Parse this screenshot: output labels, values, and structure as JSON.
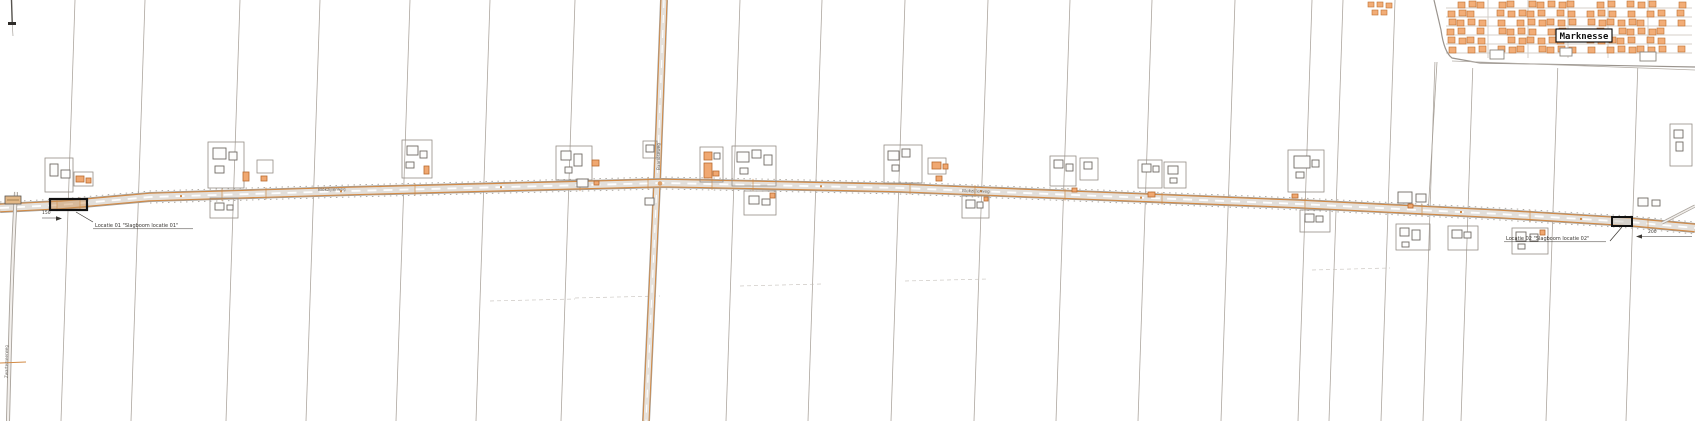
{
  "map": {
    "town": {
      "label": "Marknesse"
    },
    "annotations": {
      "location1": "Locatie 01 \"Slagboom locatie 01\"",
      "location2": "Locatie 02 \"Slagboom locatie 02\"",
      "distance1": "150",
      "distance2": "200"
    },
    "roads": {
      "main": "Blokzijlerweg",
      "main2": "Blokzijlerweg",
      "cross": "Baarloseweg",
      "left_edge": "Zwartemeerweg"
    },
    "colors": {
      "road_casing": "#d28a45",
      "road_fill": "#e3dfda",
      "parcel_line": "#a9a29a",
      "building_outline": "#6f6a64",
      "orange_building": "#f0a871",
      "marker_outline": "#111111"
    }
  }
}
